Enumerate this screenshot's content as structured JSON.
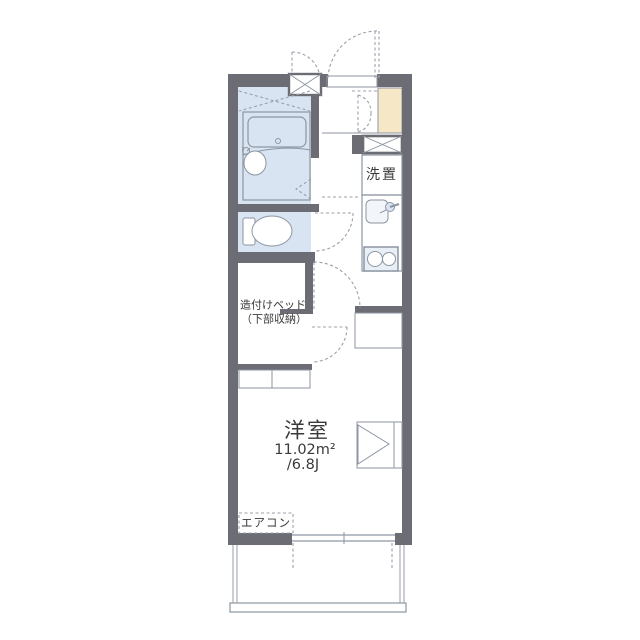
{
  "floorplan": {
    "labels": {
      "laundry": "洗置",
      "built_in_bed_line1": "造付けベッド",
      "built_in_bed_line2": "（下部収納）",
      "room_name": "洋室",
      "room_area_sqm": "11.02m²",
      "room_area_tatami": "/6.8J",
      "aircon": "エアコン"
    },
    "colors": {
      "wall": "#6c6c74",
      "room": "#d9e4f2",
      "fixture": "#e9eff7",
      "beige": "#f6e8c7",
      "line": "#8d96a2",
      "dash": "#9aa1ab",
      "text": "#3a3a3a"
    }
  }
}
